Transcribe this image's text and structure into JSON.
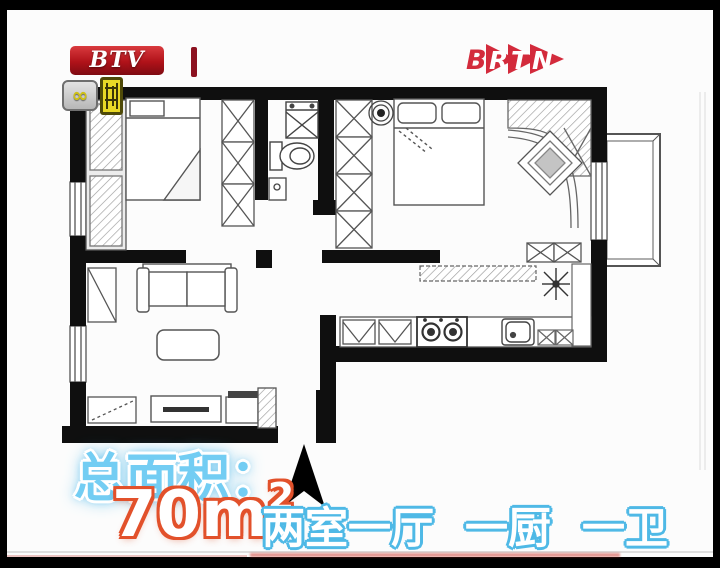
{
  "broadcast": {
    "btv_label": "BTV",
    "brtn_b": "B",
    "brtn_r": "R",
    "brtn_t": "T",
    "brtn_n": "N"
  },
  "badges": {
    "infinity_glyph": "∞"
  },
  "caption": {
    "total_area_label": "总面积：",
    "area_value": "70m",
    "area_exponent": "2",
    "layout_text": "两室一厅 一厨 一卫"
  },
  "colors": {
    "caption_light_blue": "#73cdf3",
    "caption_orange_outline": "#e2512b",
    "caption_blue_outline": "#4fb9e6",
    "logo_red": "#c41420",
    "badge_yellow": "#e8d826",
    "wall_black": "#0f0f0f"
  }
}
